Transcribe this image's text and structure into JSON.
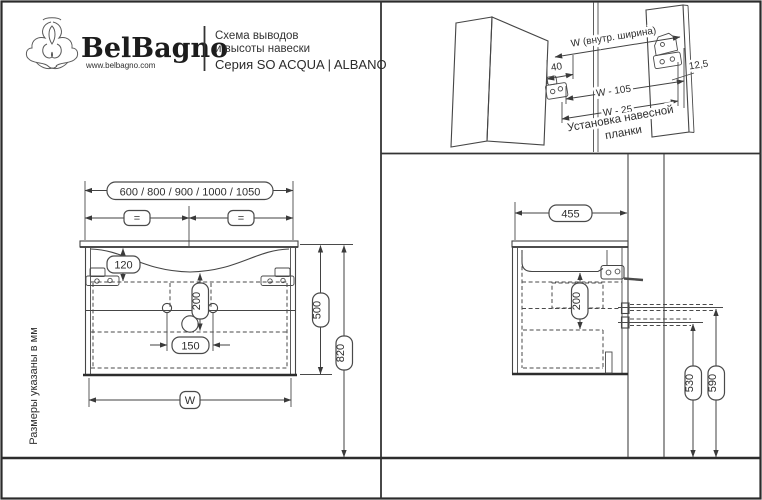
{
  "colors": {
    "line": "#454545",
    "text": "#2e2e2e",
    "background": "#ffffff"
  },
  "header": {
    "brand": "BelBagno",
    "website": "www.belbagno.com",
    "subtitle_line1": "Схема выводов",
    "subtitle_line2": "и высоты навески",
    "series": "Серия SO ACQUA | ALBANO"
  },
  "note_vertical": "Размеры указаны в мм",
  "front_view": {
    "width_options": "600 / 800 / 900 / 1000 / 1050",
    "equal_left": "=",
    "equal_right": "=",
    "dim_120": "120",
    "dim_200": "200",
    "dim_150": "150",
    "dim_500": "500",
    "dim_820": "820",
    "dim_w": "W"
  },
  "side_view": {
    "dim_455": "455",
    "dim_200": "200",
    "dim_530": "530",
    "dim_590": "590"
  },
  "detail_view": {
    "dim_w_inner": "W (внутр.  ширина)",
    "dim_40": "40",
    "dim_12_5": "12,5",
    "dim_w_105": "W - 105",
    "dim_w_25": "W - 25",
    "caption_line1": "Установка навесной",
    "caption_line2": "планки"
  }
}
